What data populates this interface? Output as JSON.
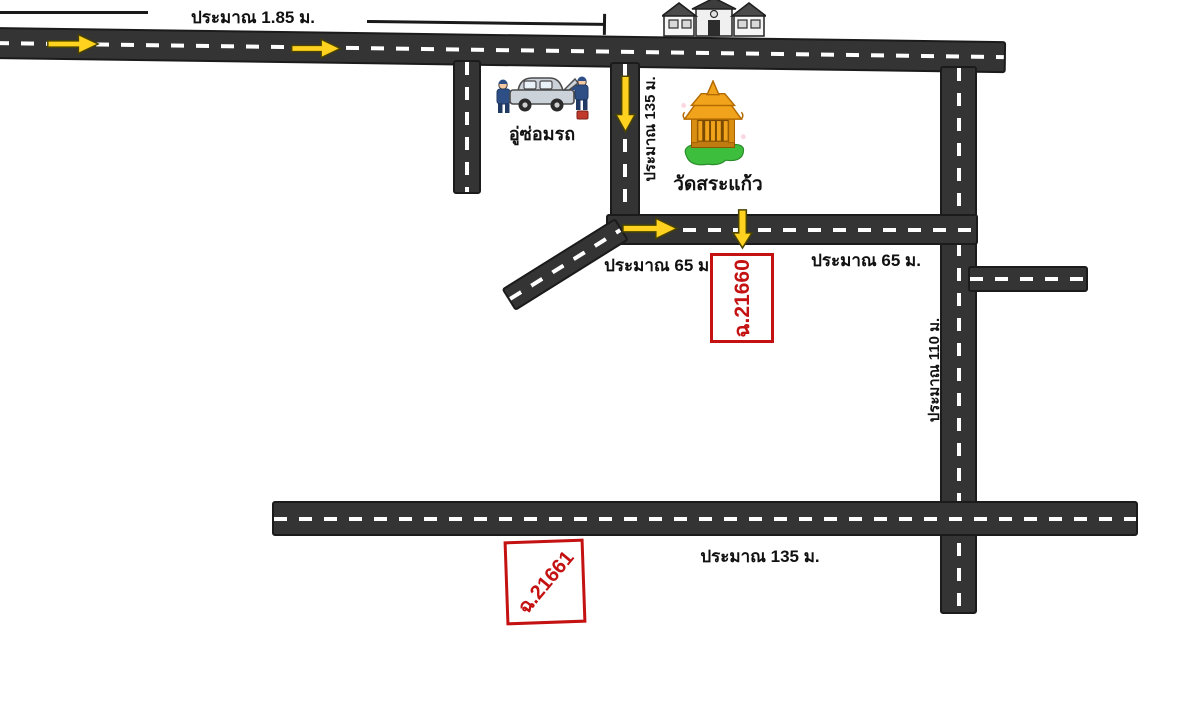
{
  "map": {
    "measurements": {
      "top": "ประมาณ 1.85 ม.",
      "soi_vertical": "ประมาณ 135 ม.",
      "middle_left": "ประมาณ 65 ม.",
      "middle_right": "ประมาณ 65 ม.",
      "right_vertical": "ประมาณ 110 ม.",
      "bottom": "ประมาณ 135 ม."
    },
    "places": {
      "garage": "อู่ซ่อมรถ",
      "temple": "วัดสระแก้ว"
    },
    "parcels": {
      "parcel_top": "ฉ.21660",
      "parcel_bottom": "ฉ.21661"
    },
    "icons": {
      "house": "house-icon",
      "temple": "thai-temple-icon",
      "garage": "car-repair-icon",
      "arrow_right": "arrow-right-icon",
      "arrow_down": "arrow-down-icon"
    },
    "colors": {
      "road": "#343434",
      "road_dash": "#ffffff",
      "arrow_yellow": "#ffd21f",
      "parcel_red": "#c41212",
      "label_text": "#111111",
      "temple_gold": "#f2a31c",
      "grass_green": "#3dbe3d",
      "background": "#ffffff"
    }
  }
}
